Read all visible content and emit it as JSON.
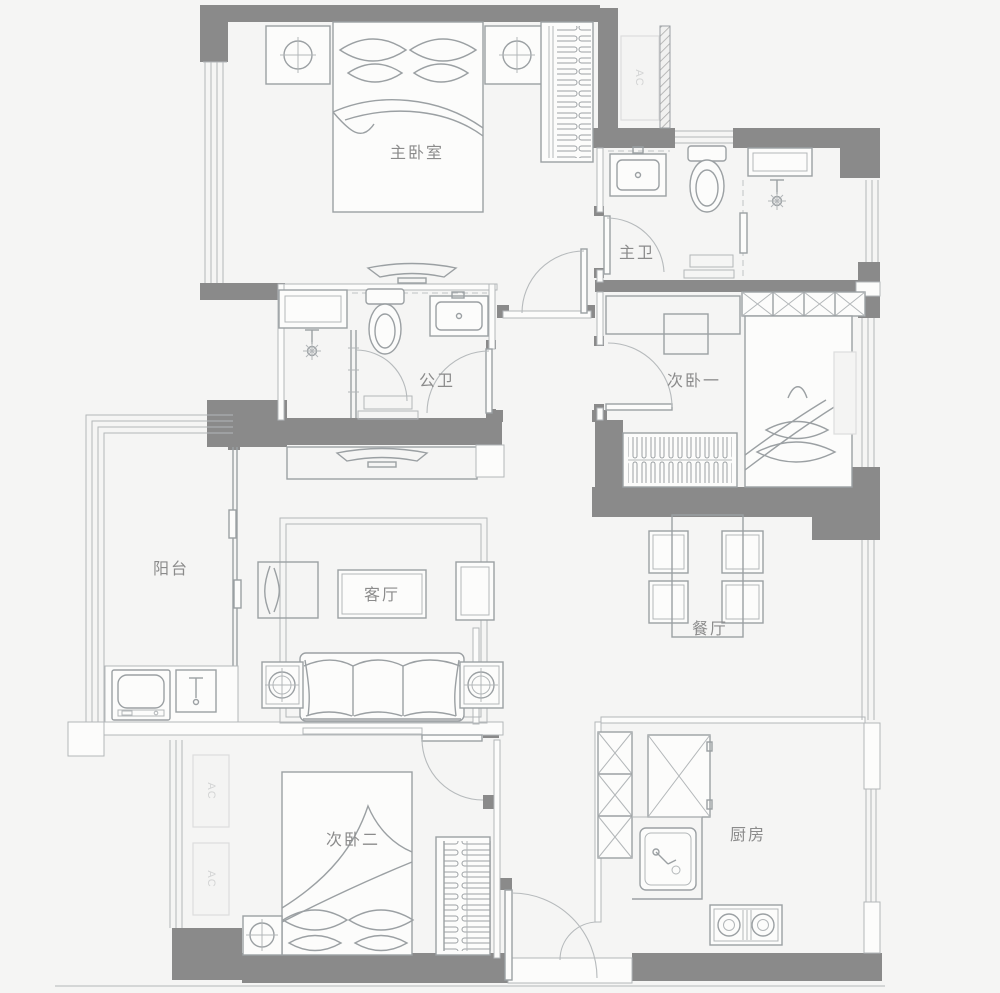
{
  "floor_plan": {
    "rooms": [
      {
        "id": "master-bedroom",
        "label": "主卧室"
      },
      {
        "id": "master-bathroom",
        "label": "主卫"
      },
      {
        "id": "guest-bathroom",
        "label": "公卫"
      },
      {
        "id": "bedroom-one",
        "label": "次卧一"
      },
      {
        "id": "balcony",
        "label": "阳台"
      },
      {
        "id": "living-room",
        "label": "客厅"
      },
      {
        "id": "dining-room",
        "label": "餐厅"
      },
      {
        "id": "bedroom-two",
        "label": "次卧二"
      },
      {
        "id": "kitchen",
        "label": "厨房"
      }
    ],
    "ac_label": "AC",
    "colors": {
      "wall": "#8a8a8a",
      "furniture_line": "#9ba0a3",
      "faint_line": "#dcdddd",
      "label_text": "#8b8b8b",
      "background": "#f5f5f4"
    }
  }
}
